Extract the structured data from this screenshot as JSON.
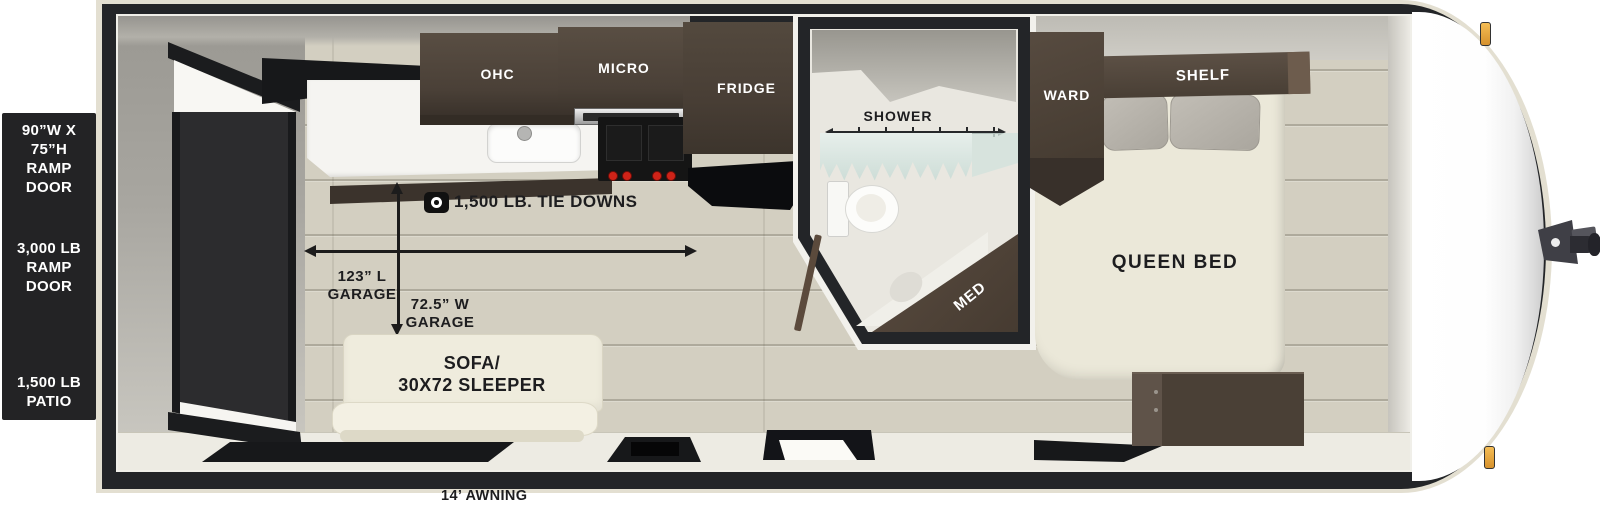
{
  "floorplan": {
    "exterior_labels": {
      "ramp_door_size": {
        "line1": "90”W X 75”H",
        "line2": "RAMP DOOR"
      },
      "ramp_door_capacity": {
        "line1": "3,000 LB",
        "line2": "RAMP DOOR"
      },
      "patio_capacity": {
        "line1": "1,500 LB",
        "line2": "PATIO"
      },
      "awning": "14’ AWNING"
    },
    "kitchen": {
      "ohc": "OHC",
      "micro": "MICRO",
      "fridge": "FRIDGE"
    },
    "garage": {
      "tie_downs": "1,500 LB. TIE DOWNS",
      "length": {
        "line1": "123” L",
        "line2": "GARAGE"
      },
      "width": {
        "line1": "72.5” W",
        "line2": "GARAGE"
      }
    },
    "living": {
      "sofa_line1": "SOFA/",
      "sofa_line2": "30X72 SLEEPER"
    },
    "bathroom": {
      "shower": "SHOWER",
      "med_cabinet": "MED"
    },
    "bedroom": {
      "wardrobe": "WARD",
      "shelf": "SHELF",
      "bed": "QUEEN BED"
    },
    "colors": {
      "panel_black": "#232325",
      "frame_black": "#232528",
      "trim_cream": "#e3dfd1",
      "floor_wood": "#d3cfc1",
      "cabinet_brown": "#4c4238",
      "furniture_cream": "#efecdd",
      "curtain_mint": "#d9e6e1",
      "marker_amber": "#e8a43e"
    }
  }
}
